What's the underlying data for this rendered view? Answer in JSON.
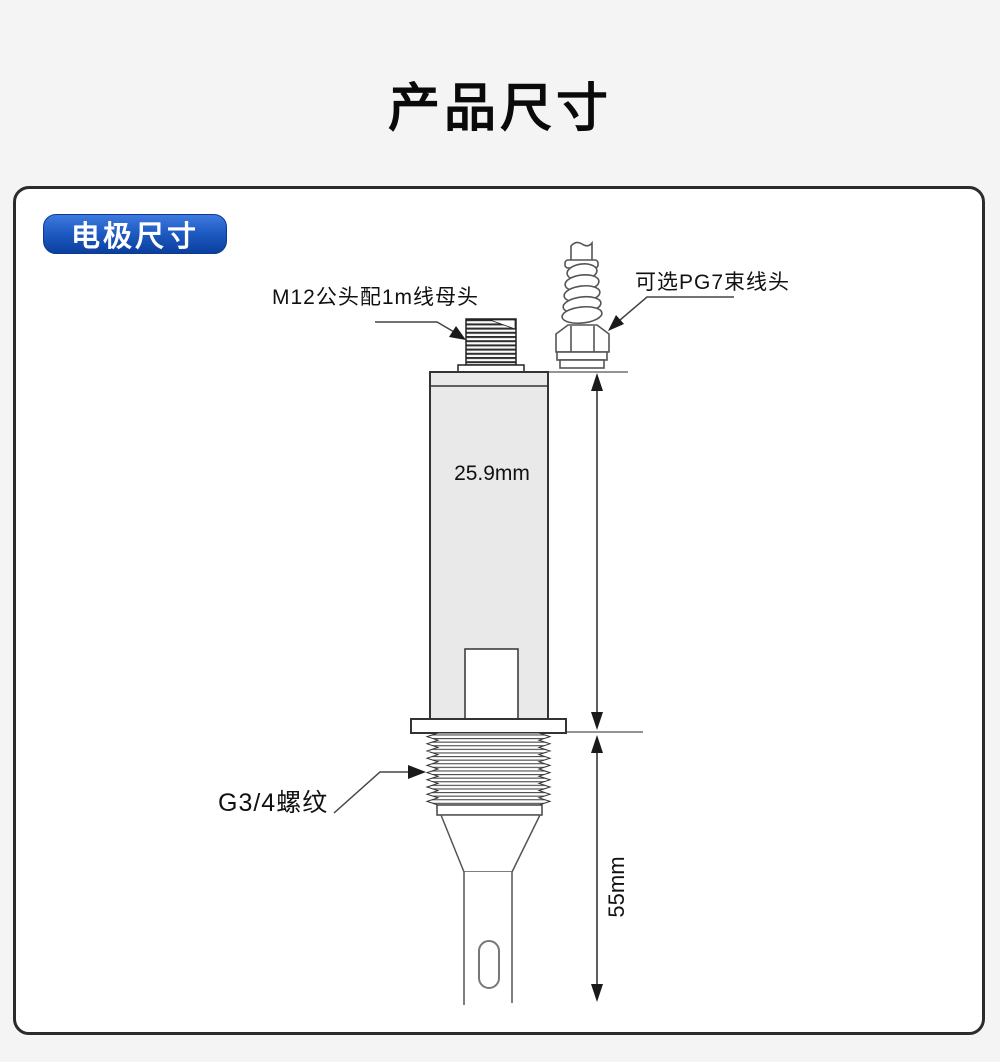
{
  "page": {
    "title": "产品尺寸"
  },
  "panel": {
    "badge_label": "电极尺寸"
  },
  "diagram": {
    "labels": {
      "m12_connector": "M12公头配1m线母头",
      "pg7_gland": "可选PG7束线头",
      "body_diameter": "25.9mm",
      "thread_spec": "G3/4螺纹",
      "probe_length": "55mm"
    },
    "colors": {
      "badge_gradient_top": "#3e7ade",
      "badge_gradient_bottom": "#0b3f9e",
      "panel_border": "#2b2b2b",
      "body_fill": "#e9e9e9",
      "outline": "#3a3a3a",
      "dimension_line": "#1a1a1a",
      "page_background": "#f4f4f4"
    }
  }
}
